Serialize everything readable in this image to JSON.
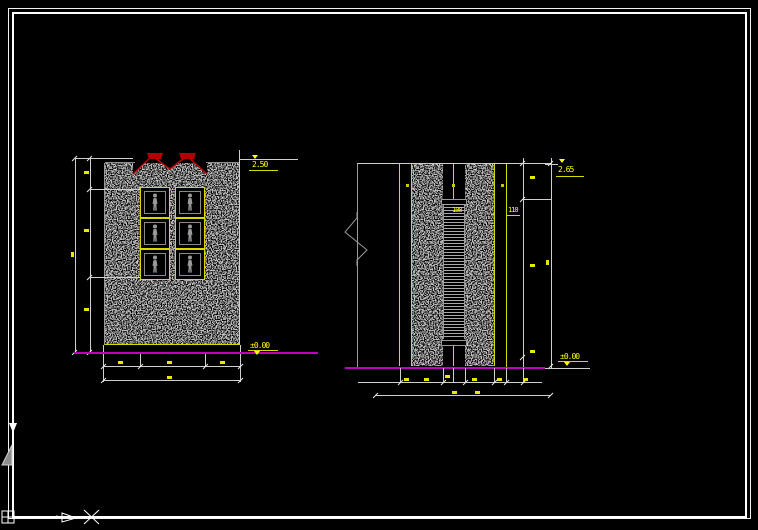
{
  "viewport": {
    "kind": "cad-drawing-canvas",
    "background": "#000000",
    "colors": {
      "border": "#ffffff",
      "dimension_lines": "#cfcfcf",
      "dimension_text": "#ffff00",
      "hatch": "#8f8f8f",
      "frame_outline": "#d8d800",
      "lights": "#c00000",
      "ground_line": "#bf00bf"
    }
  },
  "left_view": {
    "description": "wall-elevation-with-framed-figures",
    "level_top": "2.50",
    "level_bottom": "±0.00",
    "frame_rows": 3,
    "frame_cols": 2
  },
  "right_view": {
    "description": "wall-section-with-louver-panel",
    "level_top": "2.65",
    "level_bottom": "±0.00",
    "dim_panel": "100",
    "dim_offset": "110"
  }
}
